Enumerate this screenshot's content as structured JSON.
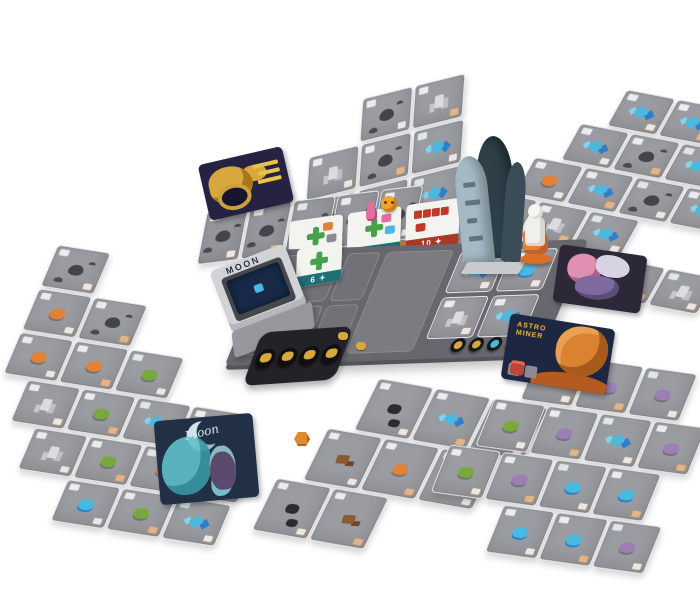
{
  "logo": {
    "text": "MOON"
  },
  "objective_tiles": [
    {
      "label": "6 ✦",
      "strip": "teal"
    },
    {
      "label": "7 ✦",
      "strip": "teal"
    },
    {
      "label": "10 ✦",
      "strip": "red"
    }
  ],
  "board_tile": {
    "label": "6 ✦"
  },
  "event_card": {
    "title_line1": "ASTRO",
    "title_line2": "MINER"
  },
  "ghost_card": {
    "title": "Moon"
  },
  "palette": {
    "card": "#9b9ca1",
    "boardDark": "#67676d",
    "slotBorder": "#8a8a90",
    "crystal": "#49b9e0",
    "crystalDeep": "#2e7fc9",
    "crystalLight": "#7fd6f0",
    "green": "#79a83c",
    "orange": "#e08338",
    "purple": "#9b7fb5",
    "brown": "#8a5a33",
    "gold": "#d8a83d",
    "tealStrip": "#1f6f75",
    "redStrip": "#a93a28",
    "redBlock": "#c0392b",
    "plusGreen": "#46a24a",
    "rocketLight": "#a4b9c3",
    "trayLight": "#d2d3d7",
    "trayMid": "#97989d",
    "stackNavy": "#182a47",
    "ghostTeal": "#5fc0ca"
  },
  "board": {
    "slot_count": 6,
    "cards": [
      "cr",
      "cb",
      "st",
      "cr"
    ],
    "tokens": [
      "black-gold",
      "black-gold",
      "black-blue",
      "gold",
      "astro"
    ]
  },
  "token_tray": {
    "tokens": [
      "gold",
      "gold",
      "gold",
      "gold"
    ]
  },
  "tableaus": [
    {
      "name": "top-tableau",
      "rows": [
        {
          "indent": 52,
          "cards": [
            "kt",
            "st"
          ]
        },
        {
          "indent": 0,
          "cards": [
            "st",
            "kt",
            "cr"
          ]
        },
        {
          "indent": 0,
          "cards": [
            "kt",
            "cr",
            "cr"
          ]
        },
        {
          "indent": 26,
          "cards": [
            "st",
            "co",
            "cr"
          ]
        }
      ]
    },
    {
      "name": "right-tableau",
      "rows": [
        {
          "indent": 75,
          "cards": [
            "cr",
            "cr",
            "kt"
          ]
        },
        {
          "indent": 50,
          "cards": [
            "cr",
            "kt",
            "cr",
            "cp"
          ]
        },
        {
          "indent": 25,
          "cards": [
            "co",
            "cr",
            "kt",
            "cr"
          ]
        },
        {
          "indent": 0,
          "cards": [
            "kt",
            "st",
            "cr"
          ]
        },
        {
          "indent": 100,
          "cards": [
            "cp",
            "cr",
            "st"
          ]
        }
      ]
    },
    {
      "name": "left-tableau",
      "rows": [
        {
          "indent": 0,
          "cards": [
            "kt"
          ]
        },
        {
          "indent": 0,
          "cards": [
            "co",
            "kt"
          ]
        },
        {
          "indent": 0,
          "cards": [
            "co",
            "co",
            "cg"
          ]
        },
        {
          "indent": 26,
          "cards": [
            "st",
            "cg",
            "cr",
            "cg"
          ]
        },
        {
          "indent": 52,
          "cards": [
            "st",
            "cg",
            "co",
            "cb"
          ]
        },
        {
          "indent": 104,
          "cards": [
            "cb",
            "cg",
            "cr"
          ]
        }
      ]
    },
    {
      "name": "bottom-center-tableau",
      "rows": [
        {
          "indent": 50,
          "cards": [
            "bk",
            "cr",
            "cr"
          ]
        },
        {
          "indent": 25,
          "cards": [
            "rk",
            "co",
            "cg"
          ]
        },
        {
          "indent": 0,
          "cards": [
            "bk",
            "rk"
          ]
        }
      ]
    },
    {
      "name": "bottom-right-tableau",
      "rows": [
        {
          "indent": 50,
          "cards": [
            "co",
            "cp",
            "cp"
          ]
        },
        {
          "indent": 25,
          "cards": [
            "cg",
            "cp",
            "cr",
            "cp"
          ]
        },
        {
          "indent": 0,
          "cards": [
            "cg",
            "cp",
            "cb",
            "cb"
          ]
        },
        {
          "indent": 75,
          "cards": [
            "cb",
            "cb",
            "cp"
          ]
        }
      ]
    },
    {
      "name": "facedown-row",
      "rows": [
        {
          "indent": 0,
          "cards": [
            "kt",
            "kt",
            "kt",
            "kt",
            "kt"
          ]
        }
      ]
    }
  ]
}
